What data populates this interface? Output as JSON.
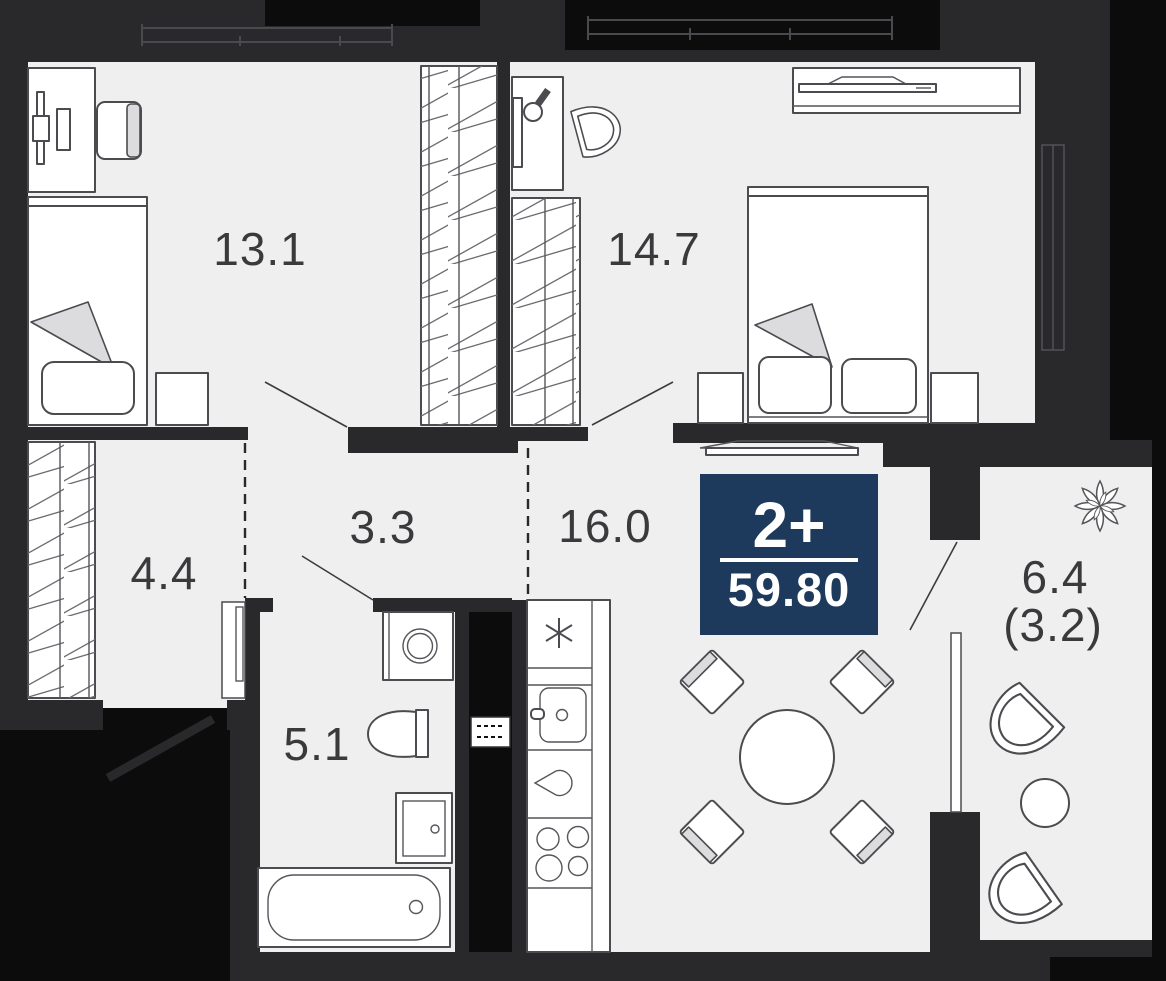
{
  "badge": {
    "layout_label": "2+",
    "total_area": "59.80",
    "bg_color": "#1d3a5c",
    "text_color": "#ffffff"
  },
  "rooms": {
    "bedroom_1": {
      "area_label": "13.1"
    },
    "bedroom_2": {
      "area_label": "14.7"
    },
    "hallway": {
      "area_label": "3.3"
    },
    "kitchen_living": {
      "area_label": "16.0"
    },
    "dressing": {
      "area_label": "4.4"
    },
    "bathroom": {
      "area_label": "5.1"
    },
    "balcony": {
      "area_label": "6.4",
      "area_label_secondary": "(3.2)"
    }
  },
  "colors": {
    "wall": "#29292c",
    "exterior": "#0c0c0c",
    "floor": "#efeff0",
    "furniture_stroke": "#4c4c50",
    "badge_bg": "#1d3a5c",
    "label_text": "#3a3a3c"
  },
  "furniture_icons": {
    "bedroom_1": [
      "desk-icon",
      "office-chair-icon",
      "single-bed-icon",
      "nightstand-icon",
      "wardrobe-icon"
    ],
    "bedroom_2": [
      "desk-icon",
      "chair-icon",
      "wardrobe-icon",
      "dresser-icon",
      "tv-icon",
      "double-bed-icon",
      "nightstand-icon"
    ],
    "bathroom": [
      "washing-machine-icon",
      "toilet-icon",
      "sink-cabinet-icon",
      "bathtub-icon"
    ],
    "kitchen_living": [
      "fridge-icon",
      "kitchen-sink-icon",
      "kettle-icon",
      "stove-icon",
      "tv-icon",
      "dining-table-icon",
      "chair-icon"
    ],
    "dressing": [
      "wardrobe-icon"
    ],
    "balcony": [
      "plant-icon",
      "armchair-icon",
      "round-table-icon"
    ]
  }
}
